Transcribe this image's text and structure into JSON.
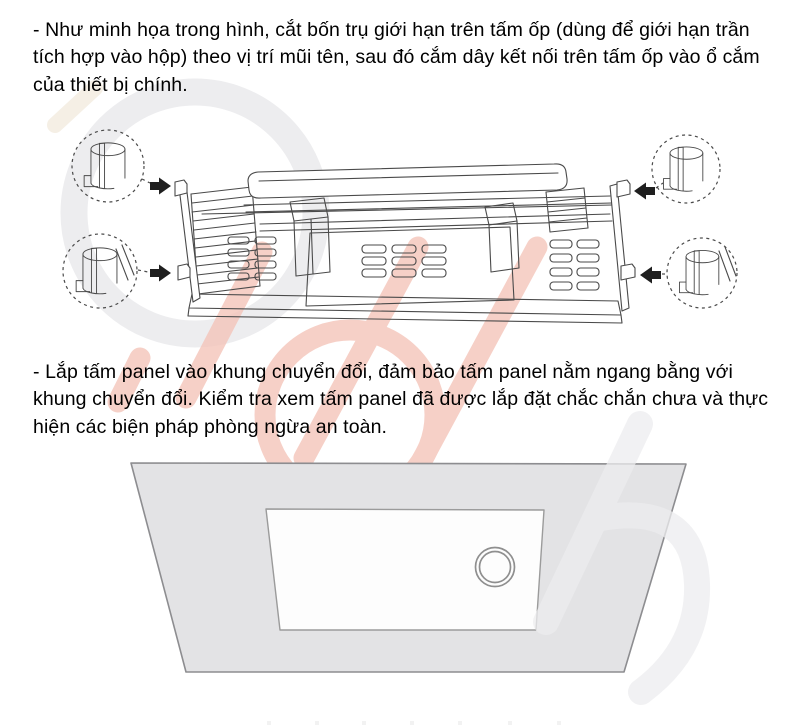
{
  "document": {
    "step1_text": "- Như minh họa trong hình, cắt bốn trụ giới hạn trên tấm ốp (dùng để giới hạn trần tích hợp vào hộp) theo vị trí mũi tên, sau đó cắm dây kết nối trên tấm ốp vào ổ cắm của thiết bị chính.",
    "step2_text": "- Lắp tấm panel vào khung chuyển đổi, đảm bảo tấm panel nằm ngang bằng với khung chuyển đổi. Kiểm tra xem tấm panel đã được lắp đặt chắc chắn chưa và thực hiện các biện pháp phòng ngừa an toàn."
  },
  "figures": {
    "exploded_view_label": "exploded line drawing of ceiling unit with four limit-post callouts and cut arrows",
    "installed_panel_label": "panel mounted flush in ceiling conversion frame"
  },
  "colors": {
    "text": "#000000",
    "line_art": "#4a4a4a",
    "arrow_fill": "#1f1f1f",
    "panel_gray": "#e3e3e5",
    "panel_stroke": "#8d8d90",
    "panel_inner": "#fdfdfd",
    "watermark_pink": "#f4c5ba",
    "watermark_gray": "#ededef",
    "watermark_beige": "#f5efe5",
    "speck": "#f2f2f2"
  }
}
